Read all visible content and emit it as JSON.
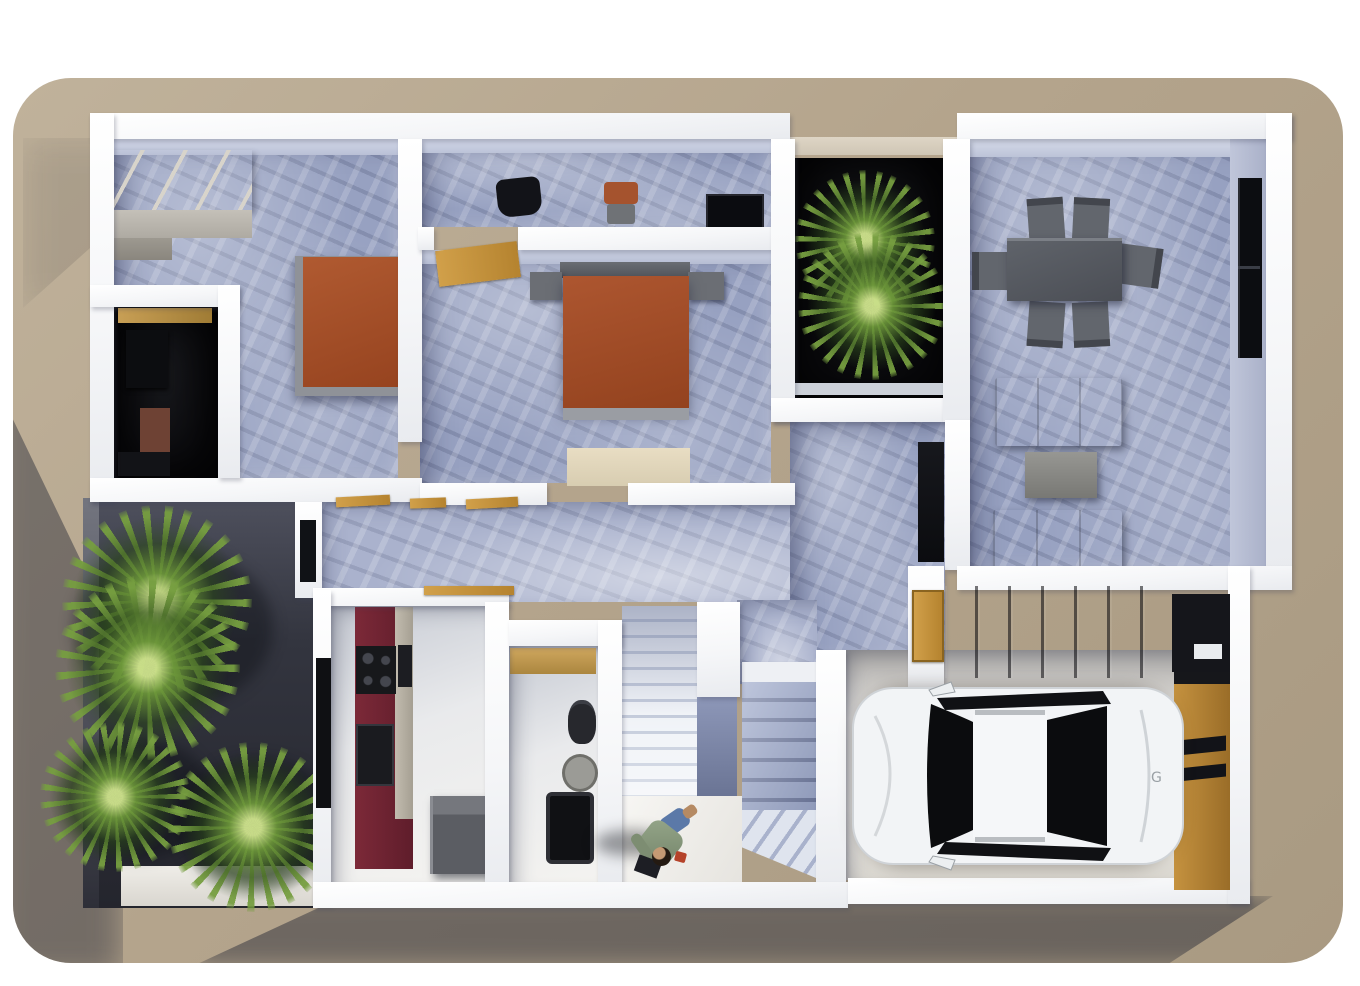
{
  "scene": {
    "type": "3d-floor-plan-render",
    "view": "top-down 3d architectural rendering, single storey house",
    "background": "white page with rounded tan ground plane, house casts shadow to lower-left"
  },
  "palette": {
    "page": "#ffffff",
    "ground_tan": "#b4a48c",
    "wall_white": "#f7f8fa",
    "floor_marble_blue": "#97a1c1",
    "floor_hall_light": "#aab2cd",
    "courtyard_black": "#0a0a0d",
    "yard_dark": "#2d2f3a",
    "bed_orange": "#a8502c",
    "sofa_brown": "#967850",
    "kitchen_accent_red": "#6e2332",
    "door_tan": "#c59a4a",
    "garage_panel_gray": "#525662",
    "garage_door_orange": "#c1923f",
    "car_white": "#f2f4f6",
    "plant_green": "#6e963c"
  },
  "exterior": {
    "front_yard": {
      "ground": "dark shaded terrace",
      "plants": 4,
      "walkway": "white path strip at lower edge"
    },
    "inner_courtyard": {
      "ground": "black lightwell floor",
      "plants": 1,
      "ledge": "beige top ledge"
    },
    "shadows": [
      "soft diagonal shadow along left edge",
      "cast shadow band below house"
    ]
  },
  "rooms": [
    {
      "name": "bedroom-1",
      "floor": "blue marble",
      "furniture": [
        "l-shaped gray wardrobe",
        "orange double bed with gray frame"
      ]
    },
    {
      "name": "walk-in-closet",
      "floor": "dark",
      "furniture": [
        "wooden shelf",
        "black cabinet",
        "brown storage box",
        "dark floor unit"
      ]
    },
    {
      "name": "study",
      "floor": "blue marble",
      "furniture": [
        "black desk chair",
        "orange chair",
        "black tv console"
      ]
    },
    {
      "name": "bedroom-2",
      "floor": "blue marble",
      "furniture": [
        "orange double bed",
        "gray headboard",
        "two gray nightstands",
        "beige rug",
        "open tan door"
      ]
    },
    {
      "name": "inner-courtyard",
      "floor": "black",
      "furniture": [
        "palm plant"
      ]
    },
    {
      "name": "dining-room",
      "floor": "blue marble",
      "furniture": [
        "gray rectangular dining table",
        "six gray chairs"
      ],
      "window": "dark vertical window slot in right wall"
    },
    {
      "name": "living-room",
      "floor": "blue marble",
      "furniture": [
        "brown sofa (back up)",
        "gray coffee table",
        "brown sofa (back down)"
      ]
    },
    {
      "name": "hallway",
      "floor": "light blue marble",
      "furniture": [
        "three open tan door leaves",
        "window slot in west wall"
      ]
    },
    {
      "name": "kitchen",
      "floor": "pale",
      "furniture": [
        "dark red counter wall",
        "black cooktop with four burners",
        "black oven",
        "gray island"
      ],
      "window": "dark slot in left wall"
    },
    {
      "name": "bathroom",
      "floor": "pale",
      "furniture": [
        "tan vanity counter",
        "dark toilet",
        "oval sink",
        "dark shower tray"
      ]
    },
    {
      "name": "staircase",
      "parts": [
        "upper light flight",
        "marble mid wall",
        "lower blue flight with white ledge",
        "diagonal winder steps",
        "bright landing"
      ]
    },
    {
      "name": "entry",
      "furniture": [
        "orange entry door",
        "dark glazed niche"
      ]
    },
    {
      "name": "garage",
      "furniture": [
        "white hatchback car",
        "gray paneled storage wall",
        "black utility box with white plate",
        "orange garage door wall with black stripes"
      ]
    }
  ],
  "figures": {
    "person": {
      "location": "stair landing",
      "pose": "walking, seen from above",
      "clothing": "sage green top, blue jeans",
      "carrying": "dark bag and small red object"
    },
    "car": {
      "color": "white",
      "type": "hatchback",
      "orientation": "parked horizontally, nose toward stairs"
    }
  }
}
